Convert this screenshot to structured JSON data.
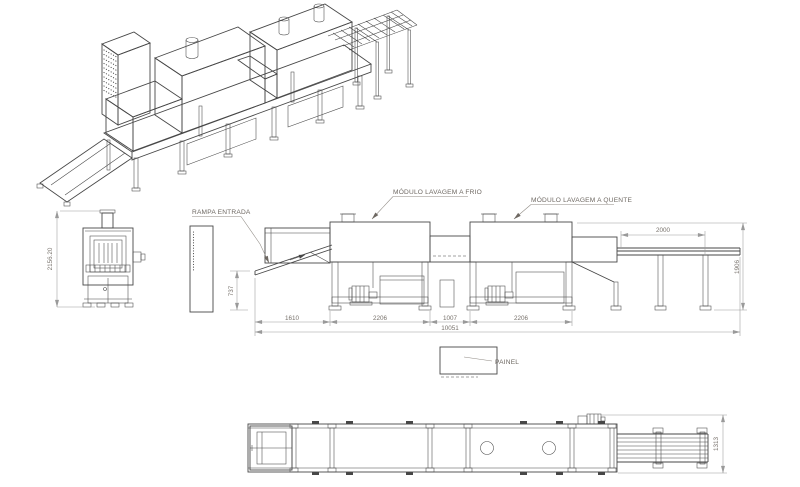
{
  "drawing": {
    "labels": {
      "cold_module": "MÓDULO LAVAGEM A FRIO",
      "hot_module": "MÓDULO LAVAGEM A QUENTE",
      "entry_ramp": "RAMPA ENTRADA",
      "panel": "PAINEL"
    },
    "dimensions": {
      "front_view_height": "2156.20",
      "ramp_tip_height": "737",
      "segment_ramp": "1610",
      "segment_cold_module": "2206",
      "segment_middle": "1007",
      "segment_hot_module": "2206",
      "total_length": "10051",
      "exit_conveyor_length": "2000",
      "overall_height": "1906",
      "plan_overall_width": "1313"
    },
    "colors": {
      "drawing_line": "#474747",
      "dimension_line": "#9a9a9a",
      "annotation_text": "#77716b",
      "background": "#ffffff"
    }
  }
}
